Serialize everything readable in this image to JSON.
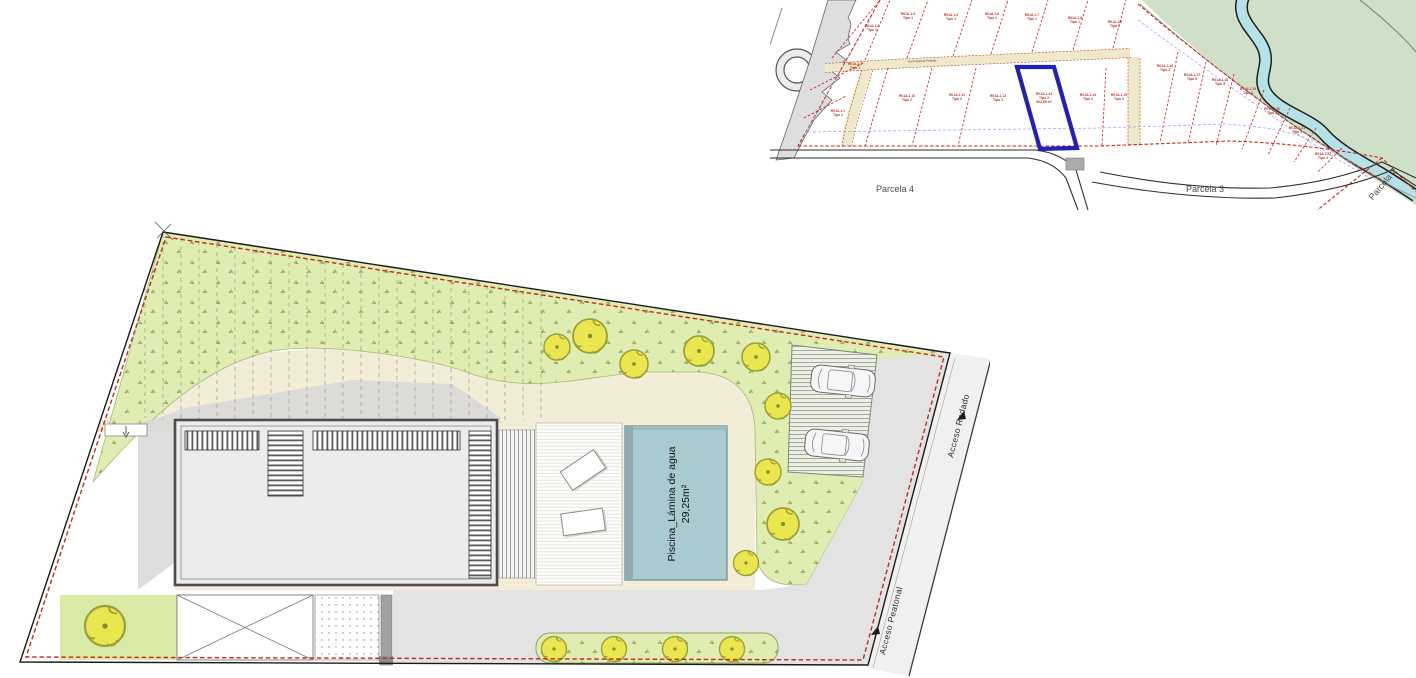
{
  "keyplan": {
    "street_label": "Vial Peatonal Privado",
    "parcels": [
      "Parcela 4",
      "Parcela 3",
      "Parcela 2"
    ],
    "highlight_color": "#2121b5",
    "lots": [
      {
        "id": "R01A.1.1",
        "tipo": "Tipo 1"
      },
      {
        "id": "R01A.1.2",
        "tipo": "Tipo 1"
      },
      {
        "id": "R01A.1.3",
        "tipo": "Tipo 1"
      },
      {
        "id": "R01A.1.4",
        "tipo": "Tipo 1"
      },
      {
        "id": "R01A.1.5",
        "tipo": "Tipo 1"
      },
      {
        "id": "R01A.1.6",
        "tipo": "Tipo 1"
      },
      {
        "id": "R01A.1.7",
        "tipo": "Tipo 1"
      },
      {
        "id": "R01A.1.8",
        "tipo": "Tipo 1"
      },
      {
        "id": "R01A.1.9",
        "tipo": "Tipo 1"
      },
      {
        "id": "R01A.1.10",
        "tipo": "Tipo 2"
      },
      {
        "id": "R01A.1.11",
        "tipo": "Tipo 2"
      },
      {
        "id": "R01A.1.12",
        "tipo": "Tipo 2"
      },
      {
        "id": "R01A.1.13",
        "tipo": "Tipo 2",
        "area": "602,85 m²",
        "highlighted": true
      },
      {
        "id": "R01A.1.14",
        "tipo": "Tipo 2"
      },
      {
        "id": "R01A.1.15",
        "tipo": "Tipo 2"
      },
      {
        "id": "R01A.1.16",
        "tipo": "Tipo 3"
      },
      {
        "id": "R01A.1.17",
        "tipo": "Tipo 3"
      },
      {
        "id": "R01A.1.18",
        "tipo": "Tipo 3"
      },
      {
        "id": "R01A.1.19",
        "tipo": "Tipo 3"
      },
      {
        "id": "R01A.1.20",
        "tipo": "Tipo 3"
      },
      {
        "id": "R01A.1.21",
        "tipo": "Tipo 3"
      },
      {
        "id": "R01A.1.22",
        "tipo": "Tipo 3"
      }
    ]
  },
  "siteplan": {
    "pool_label": "Piscina_Lámina de agua",
    "pool_area": "29,25m²",
    "access_road_label": "Acceso Rodado",
    "access_pedestrian_label": "Acceso Peatonal"
  },
  "colors": {
    "planting_green": "#dfecb2",
    "bank_green": "#cfdfc8",
    "river_blue": "#b5e2e6",
    "terrace_cream": "#f3edd8",
    "pool_water": "#a9cbd0",
    "boundary_red": "#c22a1e",
    "lot_line_red": "#c51f1f",
    "setback_blue": "#9999ee",
    "tree_yellow": "#eae64f"
  }
}
